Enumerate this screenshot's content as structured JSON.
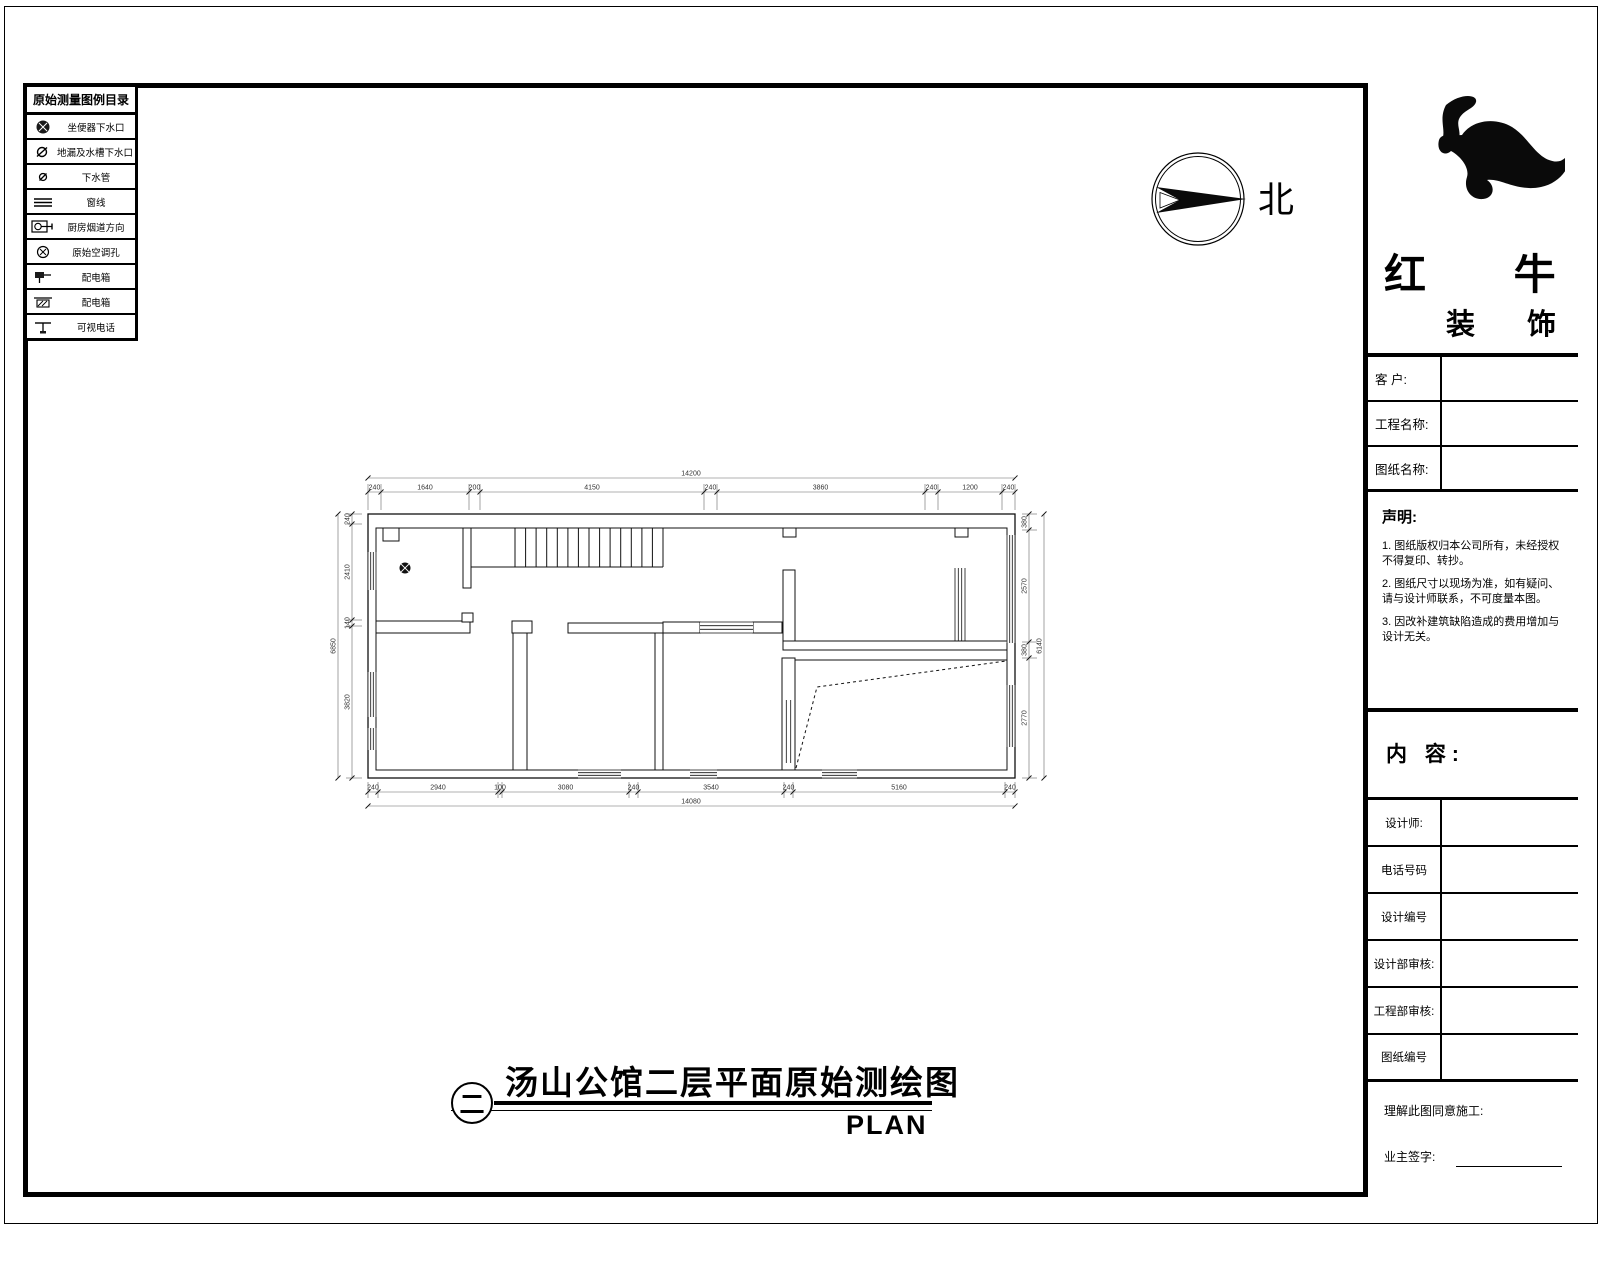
{
  "colors": {
    "ink": "#000000",
    "paper": "#ffffff"
  },
  "legend": {
    "title": "原始测量图例目录",
    "items": [
      {
        "icon": "toilet-drain-icon",
        "label": "坐便器下水口"
      },
      {
        "icon": "floor-drain-icon",
        "label": "地漏及水槽下水口"
      },
      {
        "icon": "drain-pipe-icon",
        "label": "下水管"
      },
      {
        "icon": "window-line-icon",
        "label": "窗线"
      },
      {
        "icon": "kitchen-flue-icon",
        "label": "厨房烟道方向"
      },
      {
        "icon": "ac-hole-icon",
        "label": "原始空调孔"
      },
      {
        "icon": "distribution-box-icon",
        "label": "配电箱"
      },
      {
        "icon": "distribution-box2-icon",
        "label": "配电箱"
      },
      {
        "icon": "video-phone-icon",
        "label": "可视电话"
      }
    ]
  },
  "north": {
    "label": "北"
  },
  "titleblock": {
    "brand": {
      "name": "红 牛",
      "suffix": "装 饰"
    },
    "fields": [
      {
        "label": "客 户:",
        "value": ""
      },
      {
        "label": "工程名称:",
        "value": ""
      },
      {
        "label": "图纸名称:",
        "value": ""
      }
    ],
    "statement": {
      "heading": "声明:",
      "items": [
        "1. 图纸版权归本公司所有，未经授权不得复印、转抄。",
        "2. 图纸尺寸以现场为准，如有疑问、请与设计师联系，不可度量本图。",
        "3. 因改补建筑缺陷造成的费用增加与设计无关。"
      ]
    },
    "content_heading": "内 容:",
    "info_rows": [
      {
        "label": "设计师:",
        "value": ""
      },
      {
        "label": "电话号码",
        "value": ""
      },
      {
        "label": "设计编号",
        "value": ""
      },
      {
        "label": "设计部审核:",
        "value": ""
      },
      {
        "label": "工程部审核:",
        "value": ""
      },
      {
        "label": "图纸编号",
        "value": ""
      }
    ],
    "footer": {
      "agree": "理解此图同意施工:",
      "sign": "业主签字:"
    }
  },
  "caption": {
    "sheet_symbol": "二",
    "title": "汤山公馆二层平面原始测绘图",
    "subtitle": "PLAN"
  },
  "plan": {
    "dims": {
      "top": {
        "overall": "14200",
        "segments": [
          "240",
          "1640",
          "200",
          "4150",
          "240",
          "3860",
          "240",
          "1200",
          "240"
        ]
      },
      "bottom": {
        "overall": "14080",
        "segments": [
          "240",
          "2940",
          "100",
          "3080",
          "240",
          "3540",
          "240",
          "5160",
          "240"
        ]
      },
      "left": {
        "overall": "6850",
        "segments": [
          "240",
          "2410",
          "140",
          "3820"
        ]
      },
      "right": {
        "overall": "6140",
        "segments": [
          "380",
          "2570",
          "380",
          "2770"
        ]
      }
    }
  }
}
